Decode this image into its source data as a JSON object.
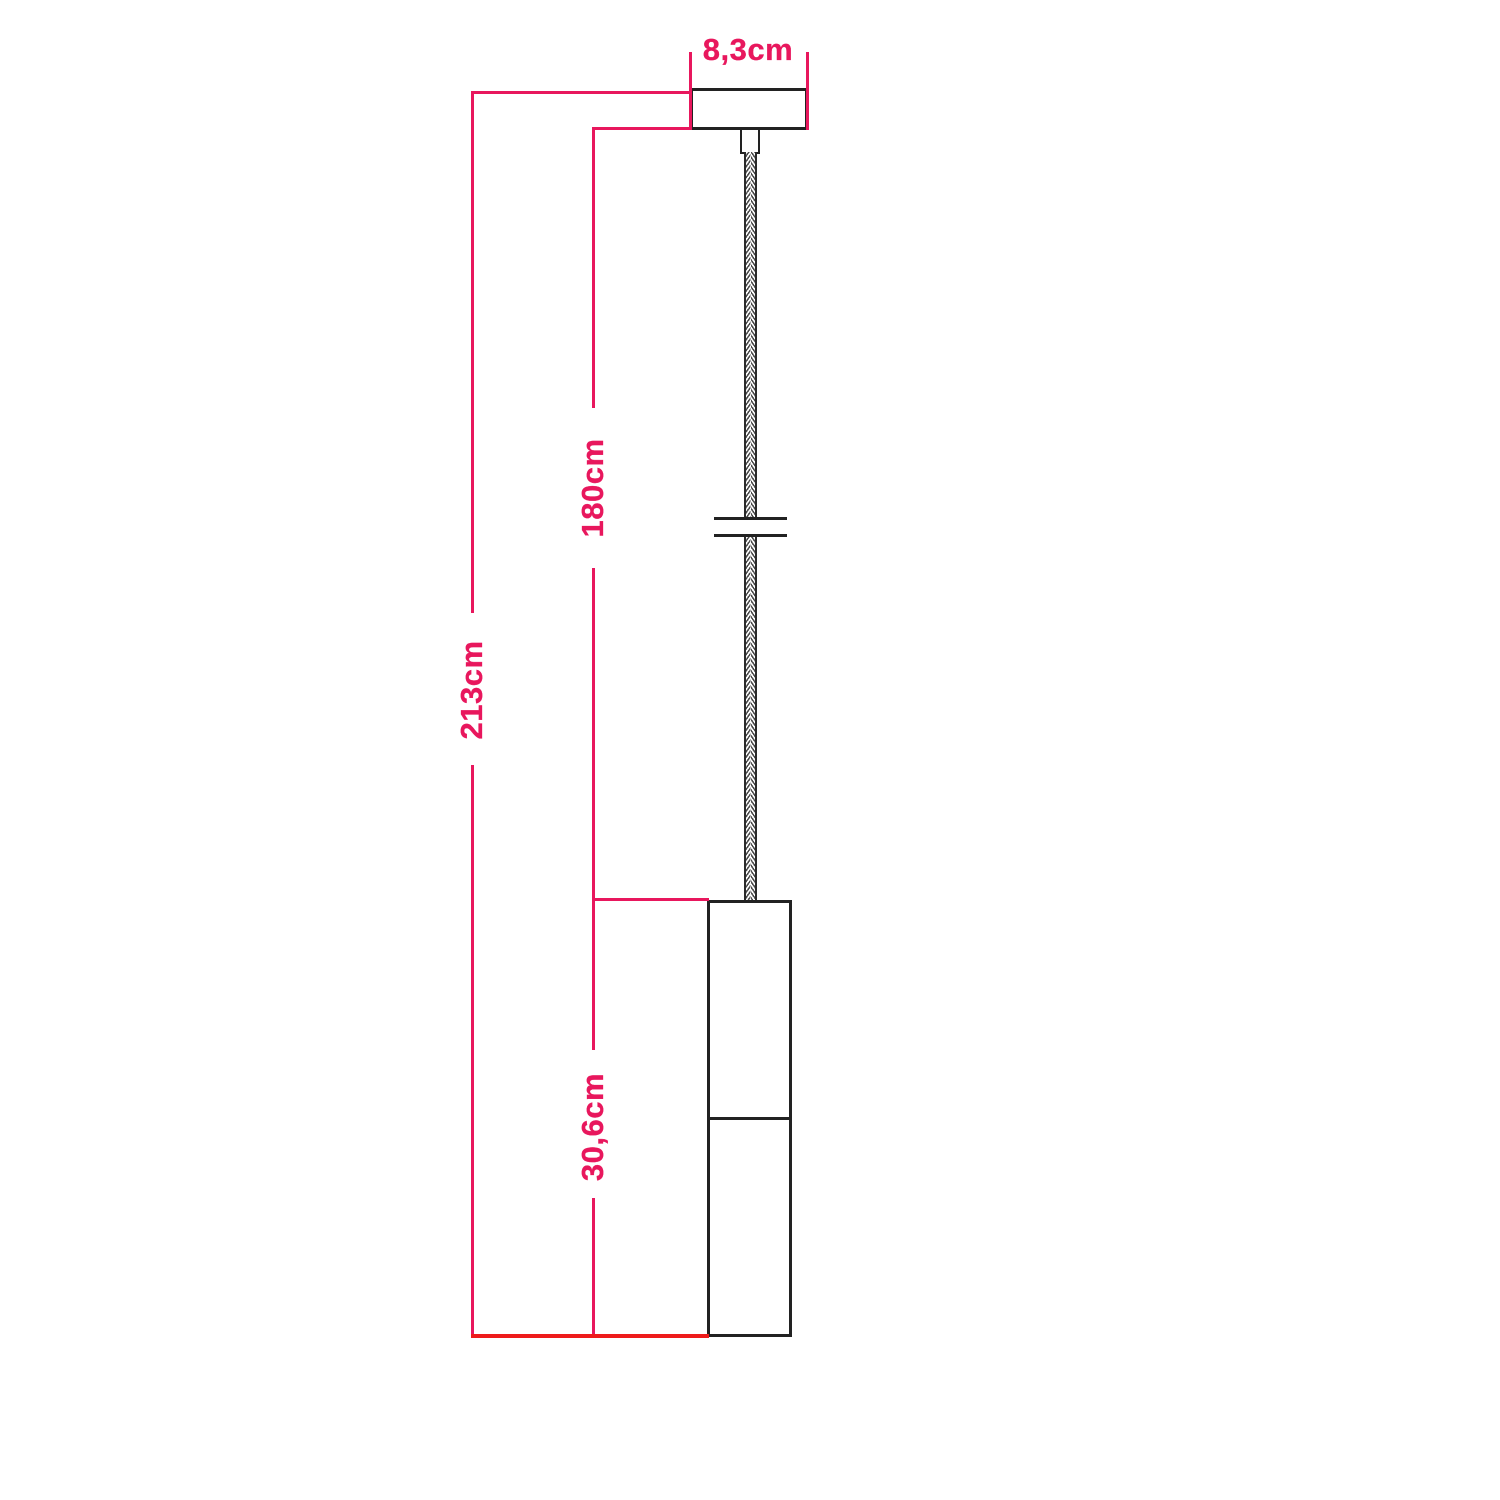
{
  "diagram": {
    "labels": {
      "canopy_width": "8,3cm",
      "cable_length": "180cm",
      "total_height": "213cm",
      "lamp_height": "30,6cm"
    },
    "colors": {
      "dimension_pink": "#e8175d",
      "baseline_red": "#ee1b1b",
      "outline_black": "#222222",
      "background": "#ffffff"
    },
    "components": [
      "ceiling-rose",
      "cable-grip",
      "braided-pendant-cable",
      "shade-ring-disc",
      "two-part-cylindrical-lamp-body"
    ]
  }
}
